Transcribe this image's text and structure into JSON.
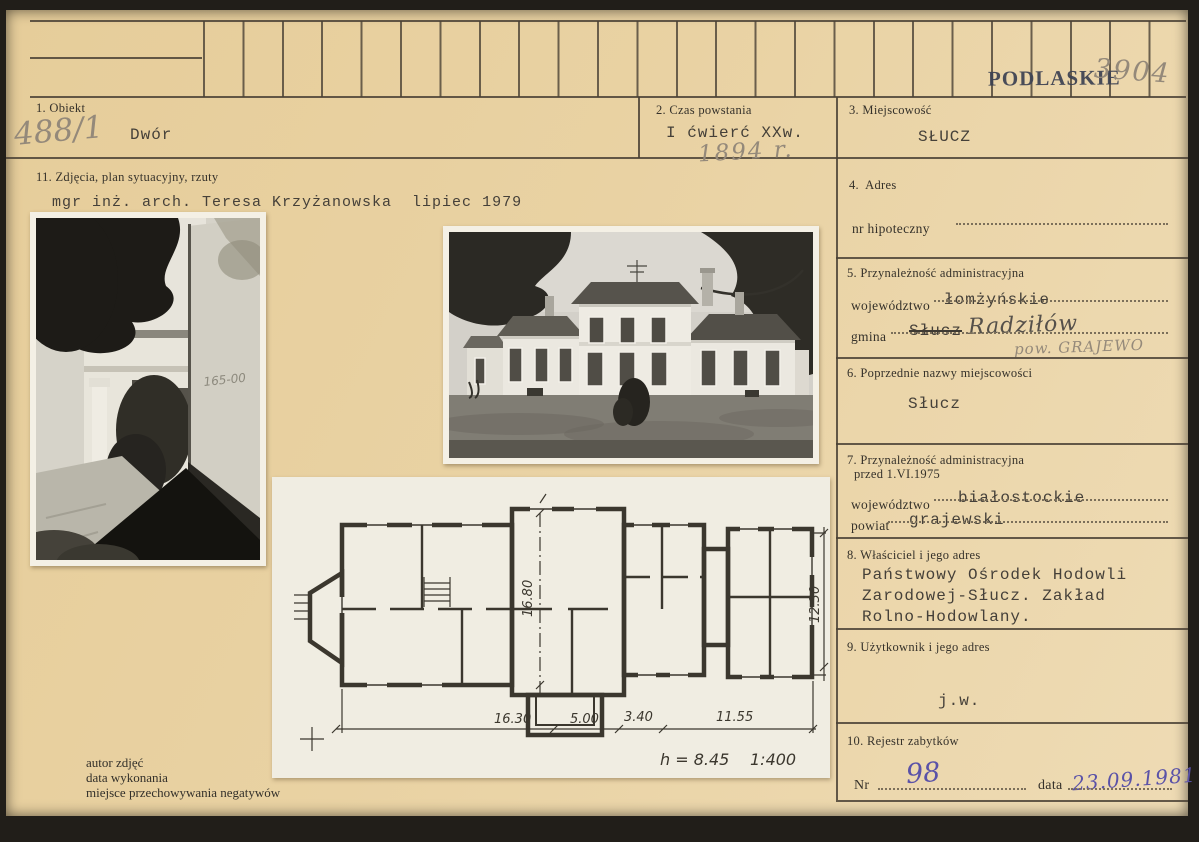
{
  "colors": {
    "card_bg": "#e9d2a3",
    "line": "#4a4135",
    "ink_blue": "#5a52a8",
    "pencil_gray": "#94897a",
    "stamp_navy": "#3c4152"
  },
  "header": {
    "stamp_region": "PODLASKIE",
    "stamp_number": "3904",
    "inventory_number": "488/1"
  },
  "sections": {
    "obiekt": {
      "label": "1. Obiekt",
      "value": "Dwór"
    },
    "czas": {
      "label": "2. Czas powstania",
      "value": "I ćwierć XXw.",
      "handwritten": "1894 r."
    },
    "miejscowosc": {
      "label": "3. Miejscowość",
      "value": "SŁUCZ"
    },
    "adres": {
      "label": "4.  Adres",
      "field_label": "nr hipoteczny"
    },
    "przynaleznosc": {
      "label": "5. Przynależność administracyjna",
      "wojewodztwo_label": "województwo",
      "wojewodztwo": "łomżyńskie",
      "gmina_label": "gmina",
      "gmina_crossed": "Słucz",
      "gmina_handwritten": "Radziłów",
      "powiat_handwritten": "pow. GRAJEWO"
    },
    "poprzednie": {
      "label": "6. Poprzednie nazwy miejscowości",
      "value": "Słucz"
    },
    "przynaleznosc_1975": {
      "label": "7. Przynależność administracyjna",
      "label_line2": "przed 1.VI.1975",
      "wojewodztwo_label": "województwo",
      "wojewodztwo": "białostockie",
      "powiat_label": "powiat",
      "powiat": "grajewski"
    },
    "wlasciciel": {
      "label": "8. Właściciel i jego adres",
      "line1": "Państwowy Ośrodek Hodowli",
      "line2": "Zarodowej-Słucz. Zakład",
      "line3": "Rolno-Hodowlany."
    },
    "uzytkownik": {
      "label": "9. Użytkownik i jego adres",
      "value": "j.w."
    },
    "rejestr": {
      "label": "10. Rejestr zabytków",
      "nr_label": "Nr",
      "nr_value": "98",
      "data_label": "data",
      "data_value": "23.09.1981"
    },
    "zdjecia": {
      "label": "11. Zdjęcia, plan sytuacyjny, rzuty",
      "author_line": "mgr inż. arch. Teresa Krzyżanowska  lipiec 1979"
    }
  },
  "photos": {
    "left_graffiti": "165-00"
  },
  "plan": {
    "dim_width_inner": "16.80",
    "dim_height_right": "12.30",
    "dim_b1": "16.30",
    "dim_b2": "5.00",
    "dim_b3": "3.40",
    "dim_b4": "11.55",
    "height_note": "h = 8.45",
    "scale": "1:400"
  },
  "footer": {
    "line1": "autor zdjęć",
    "line2": "data wykonania",
    "line3": "miejsce przechowywania negatywów"
  }
}
